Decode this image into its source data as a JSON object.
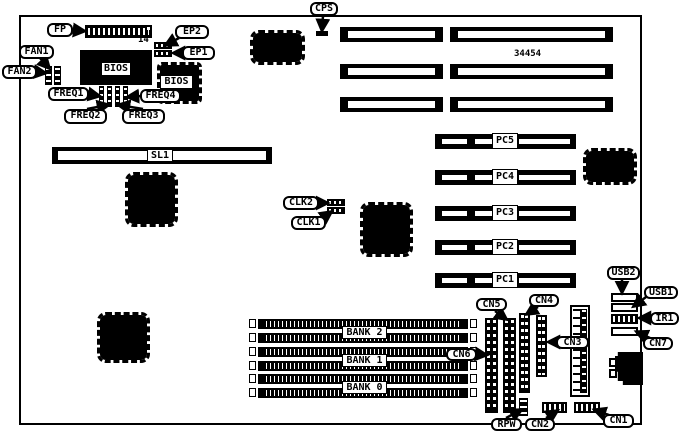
{
  "diagram": {
    "part_number": "34454",
    "fp_pin_label": "14"
  },
  "labels": {
    "fp": "FP",
    "ep1": "EP1",
    "ep2": "EP2",
    "fan1": "FAN1",
    "fan2": "FAN2",
    "bios_flash": "BIOS",
    "bios_socket": "BIOS",
    "freq1": "FREQ1",
    "freq2": "FREQ2",
    "freq3": "FREQ3",
    "freq4": "FREQ4",
    "cps": "CPS",
    "sl1": "SL1",
    "clk1": "CLK1",
    "clk2": "CLK2",
    "pc1": "PC1",
    "pc2": "PC2",
    "pc3": "PC3",
    "pc4": "PC4",
    "pc5": "PC5",
    "usb1": "USB1",
    "usb2": "USB2",
    "ir1": "IR1",
    "cn1": "CN1",
    "cn2": "CN2",
    "cn3": "CN3",
    "cn4": "CN4",
    "cn5": "CN5",
    "cn6": "CN6",
    "cn7": "CN7",
    "rpw": "RPW",
    "bank0": "BANK 0",
    "bank1": "BANK 1",
    "bank2": "BANK 2"
  },
  "colors": {
    "ink": "#000000",
    "paper": "#ffffff"
  }
}
